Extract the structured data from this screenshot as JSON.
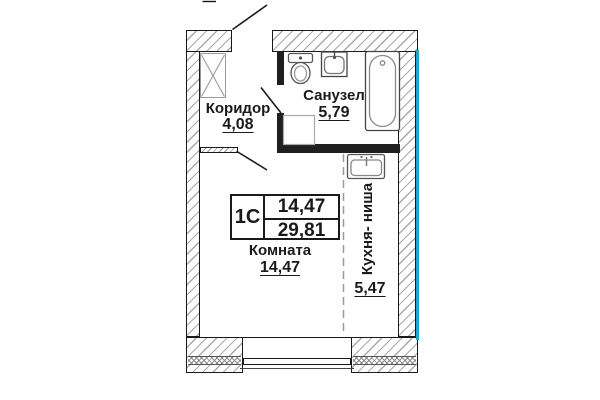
{
  "plan": {
    "unit": {
      "code": "1С",
      "room_area": "14,47",
      "total_area": "29,81"
    },
    "rooms": {
      "corridor": {
        "name": "Коридор",
        "area": "4,08"
      },
      "bathroom": {
        "name": "Санузел",
        "area": "5,79"
      },
      "living": {
        "name": "Комната",
        "area": "14,47"
      },
      "kitchen": {
        "name": "Кухня- ниша",
        "area": "5,47"
      }
    },
    "colors": {
      "line": "#1a1a1a",
      "hatch": "#a9a9a9",
      "accent": "#1ca9c9"
    }
  }
}
